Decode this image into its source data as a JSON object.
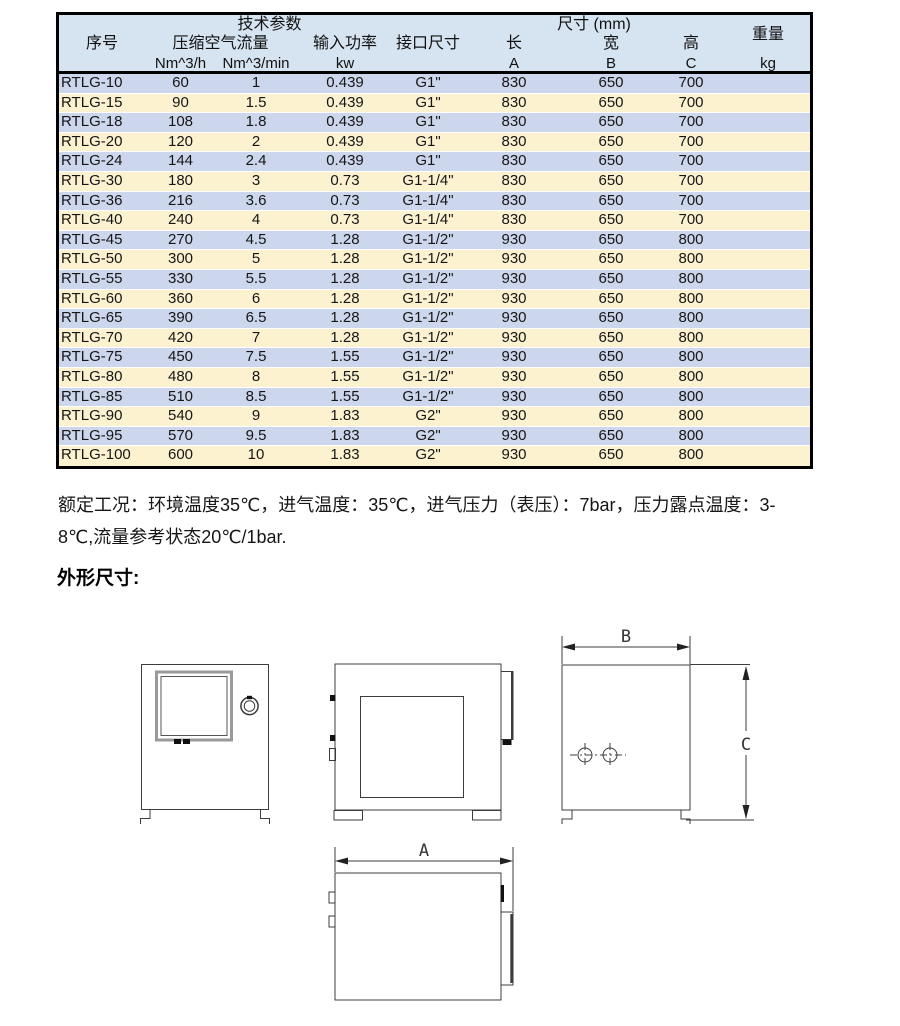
{
  "table": {
    "header": {
      "group_tech": "技术参数",
      "group_size": "尺寸 (mm)",
      "col_index": "序号",
      "col_flow": "压缩空气流量",
      "col_power": "输入功率",
      "col_interface": "接口尺寸",
      "col_len": "长",
      "col_wid": "宽",
      "col_hgt": "高",
      "col_weight": "重量",
      "unit_flow_h": "Nm^3/h",
      "unit_flow_min": "Nm^3/min",
      "unit_power": "kw",
      "unit_len": "A",
      "unit_wid": "B",
      "unit_hgt": "C",
      "unit_weight": "kg"
    },
    "rows": [
      {
        "model": "RTLG-10",
        "flow_h": "60",
        "flow_min": "1",
        "power": "0.439",
        "interface": "G1\"",
        "len": "830",
        "wid": "650",
        "hgt": "700",
        "weight": ""
      },
      {
        "model": "RTLG-15",
        "flow_h": "90",
        "flow_min": "1.5",
        "power": "0.439",
        "interface": "G1\"",
        "len": "830",
        "wid": "650",
        "hgt": "700",
        "weight": ""
      },
      {
        "model": "RTLG-18",
        "flow_h": "108",
        "flow_min": "1.8",
        "power": "0.439",
        "interface": "G1\"",
        "len": "830",
        "wid": "650",
        "hgt": "700",
        "weight": ""
      },
      {
        "model": "RTLG-20",
        "flow_h": "120",
        "flow_min": "2",
        "power": "0.439",
        "interface": "G1\"",
        "len": "830",
        "wid": "650",
        "hgt": "700",
        "weight": ""
      },
      {
        "model": "RTLG-24",
        "flow_h": "144",
        "flow_min": "2.4",
        "power": "0.439",
        "interface": "G1\"",
        "len": "830",
        "wid": "650",
        "hgt": "700",
        "weight": ""
      },
      {
        "model": "RTLG-30",
        "flow_h": "180",
        "flow_min": "3",
        "power": "0.73",
        "interface": "G1-1/4\"",
        "len": "830",
        "wid": "650",
        "hgt": "700",
        "weight": ""
      },
      {
        "model": "RTLG-36",
        "flow_h": "216",
        "flow_min": "3.6",
        "power": "0.73",
        "interface": "G1-1/4\"",
        "len": "830",
        "wid": "650",
        "hgt": "700",
        "weight": ""
      },
      {
        "model": "RTLG-40",
        "flow_h": "240",
        "flow_min": "4",
        "power": "0.73",
        "interface": "G1-1/4\"",
        "len": "830",
        "wid": "650",
        "hgt": "700",
        "weight": ""
      },
      {
        "model": "RTLG-45",
        "flow_h": "270",
        "flow_min": "4.5",
        "power": "1.28",
        "interface": "G1-1/2\"",
        "len": "930",
        "wid": "650",
        "hgt": "800",
        "weight": ""
      },
      {
        "model": "RTLG-50",
        "flow_h": "300",
        "flow_min": "5",
        "power": "1.28",
        "interface": "G1-1/2\"",
        "len": "930",
        "wid": "650",
        "hgt": "800",
        "weight": ""
      },
      {
        "model": "RTLG-55",
        "flow_h": "330",
        "flow_min": "5.5",
        "power": "1.28",
        "interface": "G1-1/2\"",
        "len": "930",
        "wid": "650",
        "hgt": "800",
        "weight": ""
      },
      {
        "model": "RTLG-60",
        "flow_h": "360",
        "flow_min": "6",
        "power": "1.28",
        "interface": "G1-1/2\"",
        "len": "930",
        "wid": "650",
        "hgt": "800",
        "weight": ""
      },
      {
        "model": "RTLG-65",
        "flow_h": "390",
        "flow_min": "6.5",
        "power": "1.28",
        "interface": "G1-1/2\"",
        "len": "930",
        "wid": "650",
        "hgt": "800",
        "weight": ""
      },
      {
        "model": "RTLG-70",
        "flow_h": "420",
        "flow_min": "7",
        "power": "1.28",
        "interface": "G1-1/2\"",
        "len": "930",
        "wid": "650",
        "hgt": "800",
        "weight": ""
      },
      {
        "model": "RTLG-75",
        "flow_h": "450",
        "flow_min": "7.5",
        "power": "1.55",
        "interface": "G1-1/2\"",
        "len": "930",
        "wid": "650",
        "hgt": "800",
        "weight": ""
      },
      {
        "model": "RTLG-80",
        "flow_h": "480",
        "flow_min": "8",
        "power": "1.55",
        "interface": "G1-1/2\"",
        "len": "930",
        "wid": "650",
        "hgt": "800",
        "weight": ""
      },
      {
        "model": "RTLG-85",
        "flow_h": "510",
        "flow_min": "8.5",
        "power": "1.55",
        "interface": "G1-1/2\"",
        "len": "930",
        "wid": "650",
        "hgt": "800",
        "weight": ""
      },
      {
        "model": "RTLG-90",
        "flow_h": "540",
        "flow_min": "9",
        "power": "1.83",
        "interface": "G2\"",
        "len": "930",
        "wid": "650",
        "hgt": "800",
        "weight": ""
      },
      {
        "model": "RTLG-95",
        "flow_h": "570",
        "flow_min": "9.5",
        "power": "1.83",
        "interface": "G2\"",
        "len": "930",
        "wid": "650",
        "hgt": "800",
        "weight": ""
      },
      {
        "model": "RTLG-100",
        "flow_h": "600",
        "flow_min": "10",
        "power": "1.83",
        "interface": "G2\"",
        "len": "930",
        "wid": "650",
        "hgt": "800",
        "weight": ""
      }
    ]
  },
  "note": {
    "line1": "额定工况：环境温度35℃，进气温度：35℃，进气压力（表压）：7bar，压力露点温度：3-",
    "line2": "8℃,流量参考状态20℃/1bar."
  },
  "section_heading": "外形尺寸:",
  "drawing": {
    "dim_a": "A",
    "dim_b": "B",
    "dim_c": "C"
  },
  "colors": {
    "row_blue": "#ccd6ec",
    "row_cream": "#fdf2d0",
    "header_blue": "#d6e3f1",
    "table_border": "#000000",
    "drawing_line": "#3c3c3c"
  }
}
